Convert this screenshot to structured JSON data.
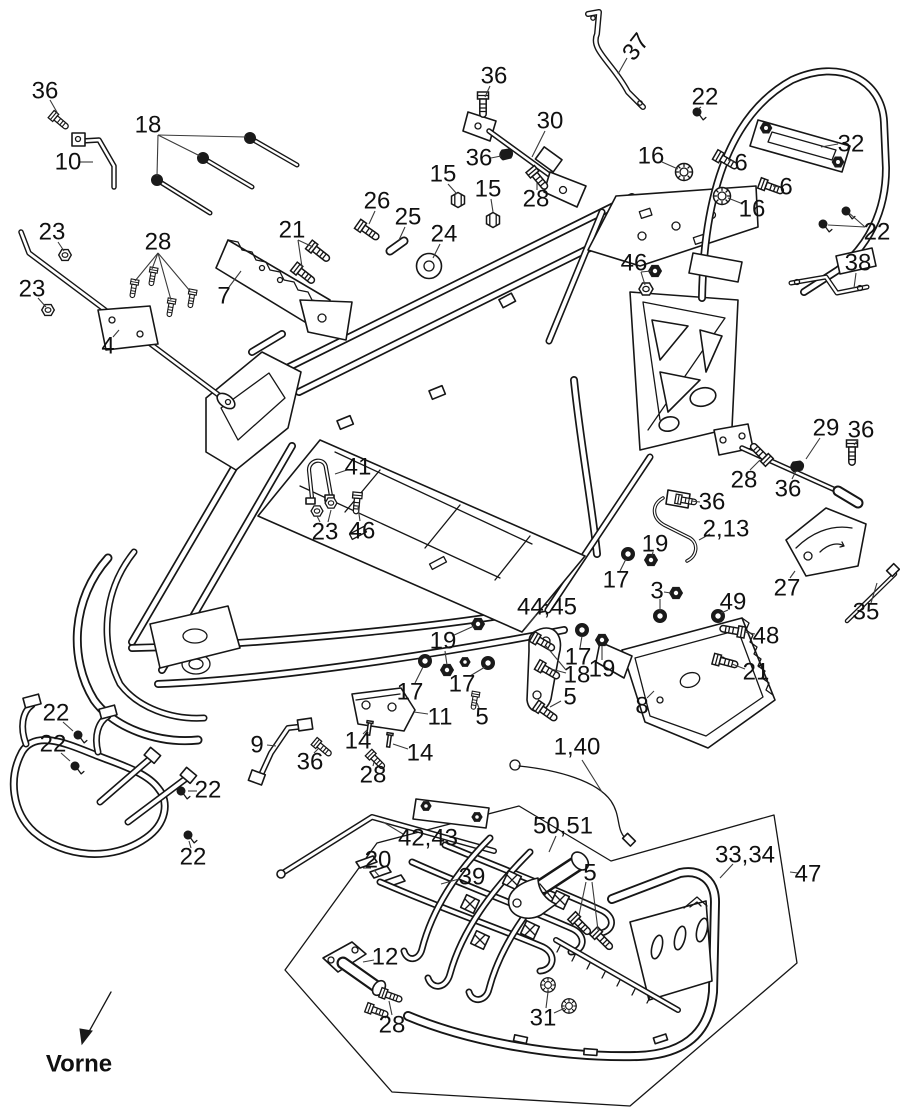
{
  "diagram": {
    "type": "exploded-parts-diagram",
    "subject": "ATV quad frame assembly parts schematic",
    "direction_label": "Vorne",
    "colors": {
      "ink": "#161616",
      "background": "#ffffff",
      "leader": "#3a3a3a"
    },
    "labels": [
      {
        "t": "36",
        "x": 45,
        "y": 91,
        "ld": [
          [
            50,
            100,
            58,
            114
          ]
        ]
      },
      {
        "t": "10",
        "x": 68,
        "y": 162,
        "ld": [
          [
            80,
            162,
            93,
            162
          ]
        ]
      },
      {
        "t": "18",
        "x": 148,
        "y": 125,
        "ld": [
          [
            158,
            135,
            157,
            176
          ],
          [
            158,
            135,
            200,
            156
          ],
          [
            158,
            135,
            246,
            137
          ]
        ]
      },
      {
        "t": "23",
        "x": 52,
        "y": 232,
        "ld": [
          [
            58,
            242,
            64,
            251
          ]
        ]
      },
      {
        "t": "23",
        "x": 32,
        "y": 289,
        "ld": [
          [
            38,
            298,
            46,
            307
          ]
        ]
      },
      {
        "t": "28",
        "x": 158,
        "y": 242,
        "ld": [
          [
            158,
            253,
            135,
            281
          ],
          [
            158,
            253,
            152,
            269
          ],
          [
            158,
            253,
            171,
            300
          ],
          [
            158,
            253,
            190,
            291
          ]
        ]
      },
      {
        "t": "7",
        "x": 224,
        "y": 296,
        "ld": [
          [
            229,
            287,
            241,
            271
          ]
        ]
      },
      {
        "t": "21",
        "x": 292,
        "y": 230,
        "ld": [
          [
            298,
            240,
            313,
            247
          ],
          [
            298,
            240,
            302,
            267
          ]
        ]
      },
      {
        "t": "26",
        "x": 377,
        "y": 201,
        "ld": [
          [
            375,
            211,
            369,
            224
          ]
        ]
      },
      {
        "t": "25",
        "x": 408,
        "y": 217,
        "ld": [
          [
            405,
            227,
            399,
            240
          ]
        ]
      },
      {
        "t": "24",
        "x": 444,
        "y": 234,
        "ld": [
          [
            440,
            244,
            433,
            258
          ]
        ]
      },
      {
        "t": "15",
        "x": 443,
        "y": 174,
        "ld": [
          [
            448,
            184,
            457,
            194
          ]
        ]
      },
      {
        "t": "15",
        "x": 488,
        "y": 189,
        "ld": [
          [
            491,
            199,
            493,
            212
          ]
        ]
      },
      {
        "t": "36",
        "x": 494,
        "y": 76,
        "ld": [
          [
            490,
            86,
            485,
            97
          ]
        ]
      },
      {
        "t": "37",
        "x": 636,
        "y": 47,
        "rot": -52,
        "ld": [
          [
            627,
            58,
            618,
            74
          ]
        ]
      },
      {
        "t": "30",
        "x": 550,
        "y": 121,
        "ld": [
          [
            545,
            131,
            532,
            157
          ]
        ]
      },
      {
        "t": "36",
        "x": 479,
        "y": 158,
        "ld": [
          [
            491,
            158,
            501,
            156
          ]
        ]
      },
      {
        "t": "28",
        "x": 536,
        "y": 199,
        "ld": [
          [
            537,
            190,
            537,
            183
          ]
        ]
      },
      {
        "t": "16",
        "x": 651,
        "y": 156,
        "ld": [
          [
            662,
            162,
            678,
            169
          ]
        ]
      },
      {
        "t": "16",
        "x": 752,
        "y": 209,
        "ld": [
          [
            743,
            204,
            728,
            198
          ]
        ]
      },
      {
        "t": "22",
        "x": 705,
        "y": 97,
        "ld": [
          [
            701,
            107,
            698,
            109
          ]
        ]
      },
      {
        "t": "32",
        "x": 851,
        "y": 144,
        "ld": [
          [
            838,
            144,
            821,
            147
          ]
        ]
      },
      {
        "t": "6",
        "x": 741,
        "y": 163,
        "ld": [
          [
            734,
            161,
            728,
            160
          ]
        ]
      },
      {
        "t": "6",
        "x": 786,
        "y": 187,
        "ld": [
          [
            779,
            187,
            773,
            186
          ]
        ]
      },
      {
        "t": "22",
        "x": 877,
        "y": 232,
        "ld": [
          [
            865,
            227,
            849,
            213
          ],
          [
            865,
            227,
            828,
            225
          ]
        ]
      },
      {
        "t": "38",
        "x": 858,
        "y": 263,
        "ld": [
          [
            856,
            273,
            854,
            288
          ]
        ]
      },
      {
        "t": "46",
        "x": 634,
        "y": 263,
        "ld": [
          [
            641,
            272,
            651,
            271
          ],
          [
            641,
            272,
            645,
            285
          ]
        ]
      },
      {
        "t": "29",
        "x": 826,
        "y": 428,
        "ld": [
          [
            820,
            438,
            806,
            459
          ]
        ]
      },
      {
        "t": "36",
        "x": 861,
        "y": 430,
        "ld": [
          [
            858,
            440,
            854,
            445
          ]
        ]
      },
      {
        "t": "28",
        "x": 744,
        "y": 480,
        "ld": [
          [
            750,
            470,
            760,
            460
          ]
        ]
      },
      {
        "t": "36",
        "x": 788,
        "y": 489,
        "ld": [
          [
            792,
            479,
            796,
            471
          ]
        ]
      },
      {
        "t": "36",
        "x": 712,
        "y": 502,
        "ld": [
          [
            700,
            502,
            691,
            501
          ]
        ]
      },
      {
        "t": "2,13",
        "x": 726,
        "y": 529,
        "ld": [
          [
            710,
            534,
            699,
            540
          ]
        ]
      },
      {
        "t": "19",
        "x": 655,
        "y": 544,
        "ld": [
          [
            653,
            552,
            652,
            556
          ]
        ]
      },
      {
        "t": "17",
        "x": 616,
        "y": 580,
        "ld": [
          [
            620,
            571,
            626,
            559
          ]
        ]
      },
      {
        "t": "3",
        "x": 657,
        "y": 591,
        "ld": [
          [
            664,
            592,
            671,
            593
          ],
          [
            660,
            599,
            660,
            611
          ]
        ]
      },
      {
        "t": "49",
        "x": 733,
        "y": 602,
        "ld": [
          [
            728,
            610,
            721,
            613
          ]
        ]
      },
      {
        "t": "48",
        "x": 766,
        "y": 636,
        "ld": [
          [
            755,
            634,
            745,
            632
          ]
        ]
      },
      {
        "t": "21",
        "x": 756,
        "y": 672,
        "ld": [
          [
            745,
            669,
            732,
            664
          ]
        ]
      },
      {
        "t": "27",
        "x": 787,
        "y": 588,
        "ld": [
          [
            790,
            578,
            795,
            571
          ]
        ]
      },
      {
        "t": "35",
        "x": 866,
        "y": 612,
        "ld": [
          [
            871,
            603,
            877,
            583
          ]
        ]
      },
      {
        "t": "8",
        "x": 642,
        "y": 706,
        "ld": [
          [
            647,
            698,
            654,
            691
          ]
        ]
      },
      {
        "t": "41",
        "x": 358,
        "y": 467,
        "ld": [
          [
            347,
            470,
            335,
            474
          ]
        ]
      },
      {
        "t": "23",
        "x": 325,
        "y": 532,
        "ld": [
          [
            320,
            522,
            317,
            516
          ],
          [
            328,
            522,
            331,
            510
          ]
        ]
      },
      {
        "t": "46",
        "x": 362,
        "y": 531,
        "ld": [
          [
            360,
            521,
            358,
            507
          ]
        ]
      },
      {
        "t": "44,45",
        "x": 547,
        "y": 607,
        "ld": [
          [
            536,
            615,
            525,
            629
          ]
        ]
      },
      {
        "t": "19",
        "x": 443,
        "y": 641,
        "ld": [
          [
            452,
            636,
            474,
            626
          ],
          [
            445,
            651,
            447,
            665
          ]
        ]
      },
      {
        "t": "17",
        "x": 410,
        "y": 692,
        "ld": [
          [
            415,
            683,
            423,
            667
          ]
        ]
      },
      {
        "t": "17",
        "x": 462,
        "y": 684,
        "ld": [
          [
            470,
            676,
            485,
            667
          ]
        ]
      },
      {
        "t": "17",
        "x": 578,
        "y": 657,
        "ld": [
          [
            580,
            648,
            582,
            636
          ]
        ]
      },
      {
        "t": "18",
        "x": 577,
        "y": 675,
        "ld": [
          [
            566,
            670,
            546,
            646
          ],
          [
            566,
            673,
            551,
            669
          ]
        ]
      },
      {
        "t": "19",
        "x": 602,
        "y": 669,
        "ld": [
          [
            602,
            660,
            602,
            646
          ]
        ]
      },
      {
        "t": "5",
        "x": 482,
        "y": 717,
        "ld": [
          [
            479,
            708,
            477,
            703
          ]
        ]
      },
      {
        "t": "5",
        "x": 570,
        "y": 697,
        "ld": [
          [
            561,
            701,
            550,
            707
          ]
        ]
      },
      {
        "t": "11",
        "x": 440,
        "y": 717,
        "ld": [
          [
            428,
            714,
            414,
            712
          ]
        ]
      },
      {
        "t": "14",
        "x": 358,
        "y": 741,
        "ld": [
          [
            363,
            734,
            367,
            730
          ]
        ]
      },
      {
        "t": "14",
        "x": 420,
        "y": 753,
        "ld": [
          [
            408,
            749,
            393,
            744
          ]
        ]
      },
      {
        "t": "36",
        "x": 310,
        "y": 762,
        "ld": [
          [
            314,
            753,
            318,
            749
          ]
        ]
      },
      {
        "t": "28",
        "x": 373,
        "y": 775,
        "ld": [
          [
            373,
            766,
            374,
            762
          ]
        ]
      },
      {
        "t": "9",
        "x": 257,
        "y": 745,
        "ld": [
          [
            267,
            745,
            276,
            746
          ]
        ]
      },
      {
        "t": "22",
        "x": 56,
        "y": 713,
        "ld": [
          [
            63,
            722,
            73,
            731
          ]
        ]
      },
      {
        "t": "22",
        "x": 53,
        "y": 744,
        "ld": [
          [
            61,
            753,
            70,
            761
          ]
        ]
      },
      {
        "t": "22",
        "x": 208,
        "y": 790,
        "ld": [
          [
            197,
            791,
            188,
            791
          ]
        ]
      },
      {
        "t": "22",
        "x": 193,
        "y": 857,
        "ld": [
          [
            191,
            848,
            189,
            841
          ]
        ]
      },
      {
        "t": "42,43",
        "x": 428,
        "y": 838,
        "ld": [
          [
            403,
            834,
            383,
            822
          ]
        ]
      },
      {
        "t": "20",
        "x": 378,
        "y": 860,
        "ld": [
          [
            371,
            868,
            363,
            868
          ],
          [
            374,
            870,
            379,
            876
          ]
        ]
      },
      {
        "t": "39",
        "x": 472,
        "y": 877,
        "ld": [
          [
            459,
            879,
            441,
            884
          ]
        ]
      },
      {
        "t": "50,51",
        "x": 563,
        "y": 826,
        "ld": [
          [
            556,
            836,
            549,
            852
          ]
        ]
      },
      {
        "t": "5",
        "x": 590,
        "y": 873,
        "ld": [
          [
            586,
            882,
            579,
            915
          ],
          [
            592,
            882,
            598,
            930
          ]
        ]
      },
      {
        "t": "33,34",
        "x": 745,
        "y": 855,
        "ld": [
          [
            733,
            864,
            720,
            878
          ]
        ]
      },
      {
        "t": "47",
        "x": 808,
        "y": 874,
        "ld": [
          [
            798,
            873,
            790,
            872
          ]
        ]
      },
      {
        "t": "12",
        "x": 385,
        "y": 957,
        "ld": [
          [
            374,
            960,
            363,
            962
          ]
        ]
      },
      {
        "t": "28",
        "x": 392,
        "y": 1025,
        "ld": [
          [
            392,
            1015,
            389,
            1001
          ],
          [
            386,
            1018,
            376,
            1013
          ]
        ]
      },
      {
        "t": "31",
        "x": 543,
        "y": 1018,
        "ld": [
          [
            546,
            1008,
            548,
            992
          ],
          [
            554,
            1013,
            565,
            1008
          ]
        ]
      },
      {
        "t": "1,40",
        "x": 577,
        "y": 747,
        "ld": [
          [
            582,
            760,
            602,
            792
          ]
        ]
      },
      {
        "t": "4",
        "x": 108,
        "y": 346,
        "ld": [
          [
            113,
            337,
            119,
            330
          ]
        ]
      }
    ]
  }
}
